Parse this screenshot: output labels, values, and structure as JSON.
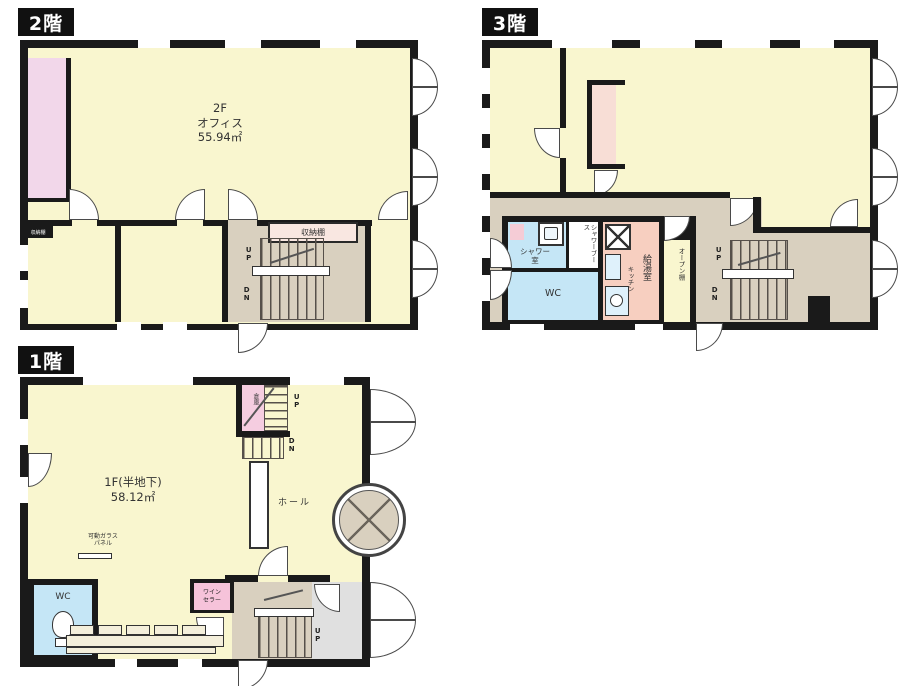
{
  "title": "建物フロアプラン(1階・2階・3階)",
  "floors": {
    "f2": {
      "tag": "2階",
      "room_line1": "2F",
      "room_line2": "オフィス",
      "room_line3": "55.94㎡",
      "shelf": "収納棚",
      "shelf_small": "収納棚",
      "up": "UP",
      "dn": "DN"
    },
    "f3": {
      "tag": "3階",
      "shower_line1": "シャワー",
      "shower_line2": "室",
      "shower_booth": "シャワーブース",
      "wc": "WC",
      "kitchen_main": "給湯室",
      "kitchen_sub": "キッチン",
      "open_shelf": "オープン棚",
      "up": "UP",
      "dn": "DN"
    },
    "f1": {
      "tag": "1階",
      "room_line1": "1F(半地下)",
      "room_line2": "58.12㎡",
      "storage": "倉庫",
      "hall": "ホール",
      "glass_line1": "可動ガラス",
      "glass_line2": "パネル",
      "wine_line1": "ワイン",
      "wine_line2": "セラー",
      "wc": "WC",
      "up_top": "UP",
      "dn_top": "DN",
      "up_entry": "UP"
    }
  },
  "colors": {
    "wall": "#1a1a1a",
    "room_cream": "#f9f6cf",
    "hall_beige": "#d9d0bf",
    "accent_pink": "#f2d7ea",
    "wet_blue": "#c5e6f6",
    "kitchen_salmon": "#f7cfc0",
    "entry_gray": "#e0e0e0",
    "wine_pink": "#f6c3da"
  }
}
